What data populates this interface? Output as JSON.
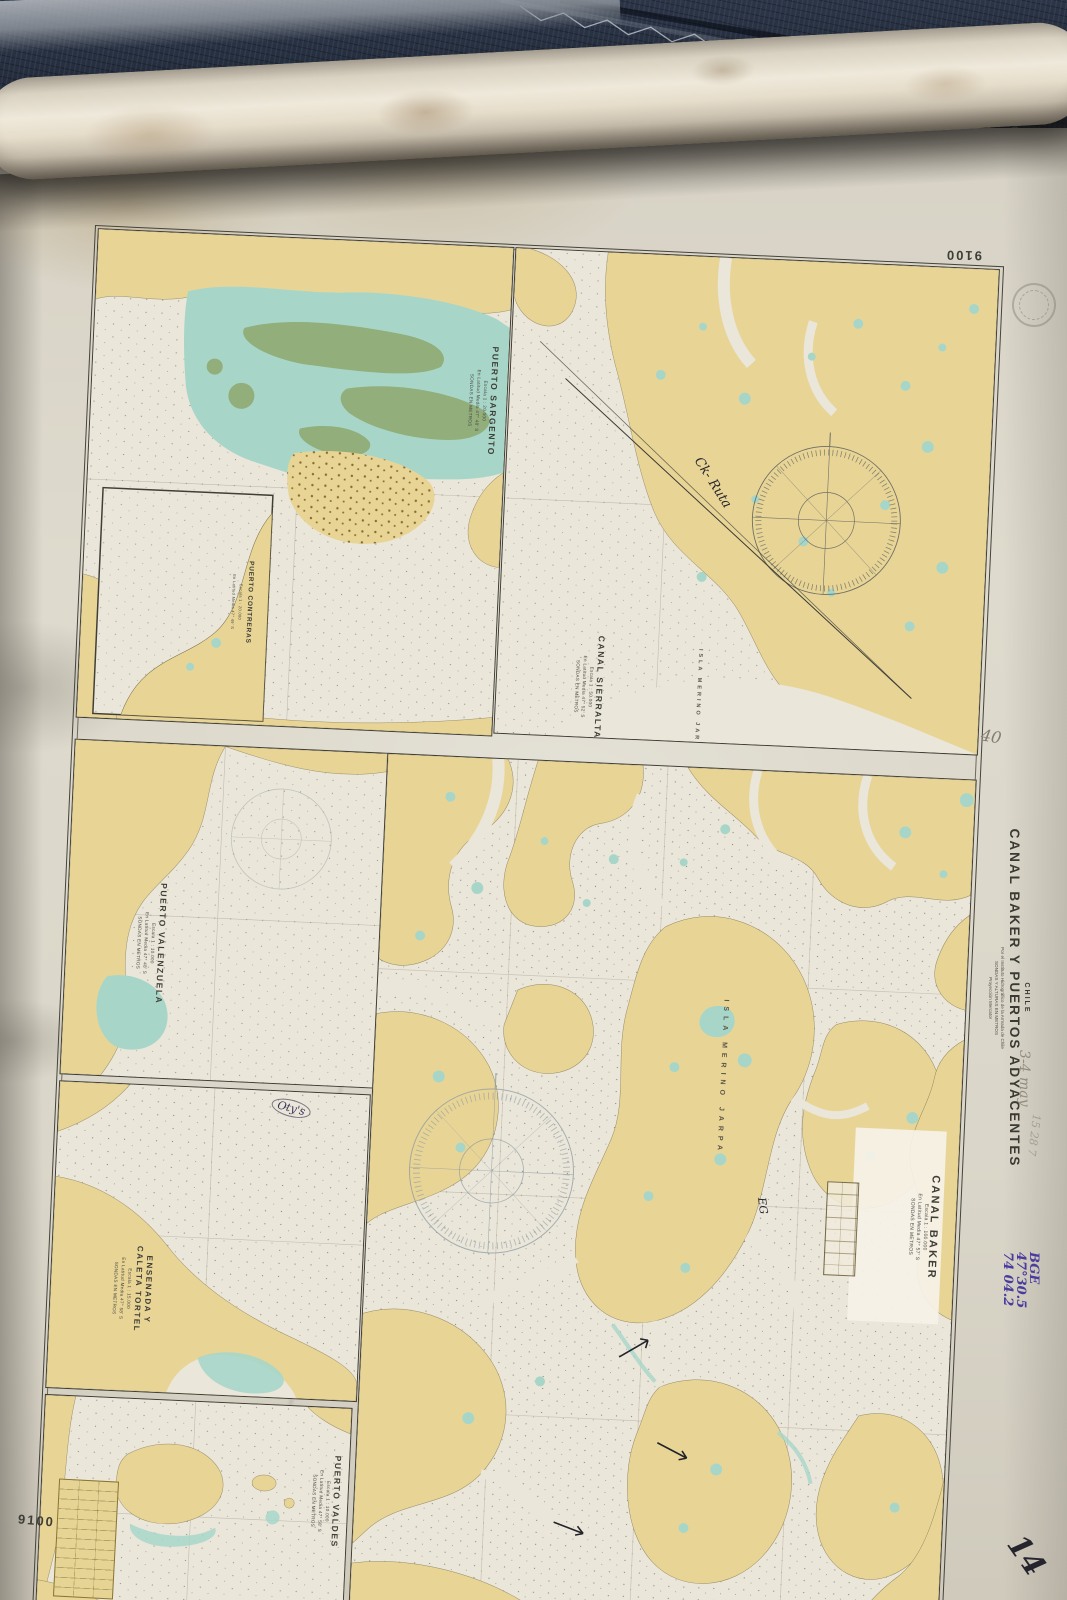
{
  "chart": {
    "number_top_right": "9100",
    "number_bottom_left": "9100",
    "country": "CHILE",
    "title": "CANAL BAKER Y PUERTOS ADYACENTES",
    "subtitle_lines": [
      "Por el Instituto Hidrográfico de la Armada de Chile",
      "SONDAS Y ALTURAS EN METROS",
      "Proyección Mercator"
    ]
  },
  "insets": {
    "sargento": {
      "title": "PUERTO SARGENTO",
      "scale": "Escala 1 : 20.000",
      "lat": "En Latitud Media 47° 48' S",
      "note": "SONDAS EN METROS"
    },
    "contreras": {
      "title": "PUERTO CONTRERAS",
      "scale": "Escala 1 : 20.000",
      "lat": "En Latitud Media 47° 49' S"
    },
    "sierralta": {
      "title": "CANAL SIERRALTA",
      "scale": "Escala 1 : 50.000",
      "lat": "En Latitud Media 47° 52' S",
      "note": "SONDAS EN METROS"
    },
    "valenzuela": {
      "title": "PUERTO VALENZUELA",
      "scale": "Escala 1 : 10.000",
      "lat": "En Latitud Media 47° 48' S",
      "note": "SONDAS EN METROS"
    },
    "tortel": {
      "title_line1": "ENSENADA Y",
      "title_line2": "CALETA TORTEL",
      "scale": "Escala 1 : 15.000",
      "lat": "En Latitud Media 47° 58' S",
      "note": "SONDAS EN METROS"
    },
    "valdes": {
      "title": "PUERTO VALDES",
      "scale": "Escala 1 : 10.000",
      "lat": "En Latitud Media 47° 58' S",
      "note": "SONDAS EN METROS"
    },
    "baker": {
      "title": "CANAL BAKER",
      "scale": "Escala 1 : 100.000",
      "lat": "En Latitud Media 47° 57' S",
      "note": "SONDAS EN METROS"
    }
  },
  "labels": {
    "isla_merino_jarpa": "ISLA MERINO JARPA"
  },
  "annotations": {
    "pencil_40": "40",
    "pencil_measure": "3-4 may",
    "pencil_numbers": "15 28 7",
    "pen_route": "Ck- Ruta",
    "pen_eg": "EG",
    "pen_otys": "Oty's",
    "purple_line1": "BGE",
    "purple_line2": "47°30.5",
    "purple_line3": "74 04.2",
    "ink_corner": "14"
  },
  "colors": {
    "land": "#e8d596",
    "shallow_water": "#a7d6c9",
    "drying_bank_green": "#91ae7b",
    "paper": "#eae6d9",
    "fabric": "#232c3a",
    "purple_ink": "#4a3c9e"
  }
}
